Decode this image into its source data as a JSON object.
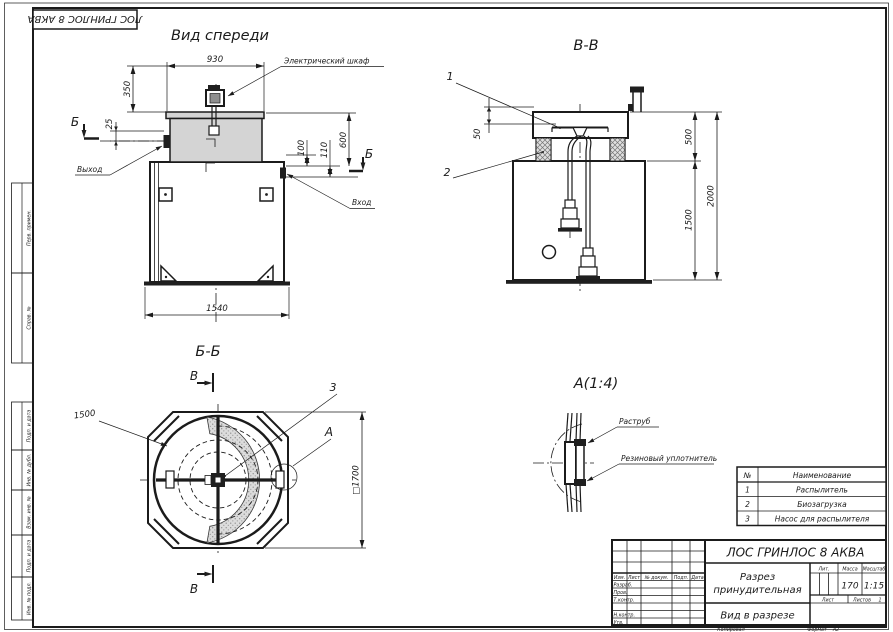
{
  "frame": {
    "top_stamp": "ЛОС ГРИНЛОС 8 АКВА",
    "side_columns": [
      "Перв. примен.",
      "Справ. №",
      "Подп. и дата",
      "Инв. № дубл.",
      "Взам. инв. №",
      "Подп. и дата",
      "Инв. № подл."
    ]
  },
  "front_view": {
    "title": "Вид спереди",
    "dim_930": "930",
    "dim_350": "350",
    "dim_25": "25",
    "dim_100": "100",
    "dim_110": "110",
    "dim_600": "600",
    "dim_1540": "1540",
    "section_letter_left": "Б",
    "section_letter_right": "Б",
    "label_cabinet": "Электрический шкаф",
    "label_outlet": "Выход",
    "label_inlet": "Вход"
  },
  "section_vv": {
    "title": "В-В",
    "callout_1": "1",
    "callout_2": "2",
    "dim_50": "50",
    "dim_500": "500",
    "dim_1500": "1500",
    "dim_2000": "2000"
  },
  "section_bb": {
    "title": "Б-Б",
    "marker_top": "В",
    "marker_bottom": "В",
    "callout_3": "3",
    "detail_letter": "А",
    "dim_1500": "1500",
    "dim_1700": "□1700"
  },
  "detail_a": {
    "title": "А(1:4)",
    "label_socket": "Раструб",
    "label_seal": "Резиновый уплотнитель"
  },
  "parts_table": {
    "header_num": "№",
    "header_name": "Наименование",
    "rows": [
      {
        "num": "1",
        "name": "Распылитель"
      },
      {
        "num": "2",
        "name": "Биозагрузка"
      },
      {
        "num": "3",
        "name": "Насос для распылителя"
      }
    ]
  },
  "title_block": {
    "doc_title": "ЛОС ГРИНЛОС 8 АКВА",
    "view_name_line1": "Разрез",
    "view_name_line2": "принудительная",
    "view_type": "Вид в разрезе",
    "col_izm": "Изм.",
    "col_list": "Лист",
    "col_doc": "№ докум.",
    "col_podp": "Подп.",
    "col_data": "Дата",
    "row_razrab": "Разраб.",
    "row_prov": "Пров.",
    "row_tkontr": "Т.контр.",
    "row_nkontr": "Н.контр.",
    "row_utv": "Утв.",
    "lit_label": "Лит.",
    "mass_label": "Масса",
    "scale_label": "Масштаб",
    "mass_value": "170",
    "scale_value": "1:15",
    "sheet_label": "Лист",
    "sheets_label": "Листов",
    "sheets_value": "1",
    "copied_label": "Копировал",
    "format_label": "Формат",
    "format_value": "А2"
  }
}
